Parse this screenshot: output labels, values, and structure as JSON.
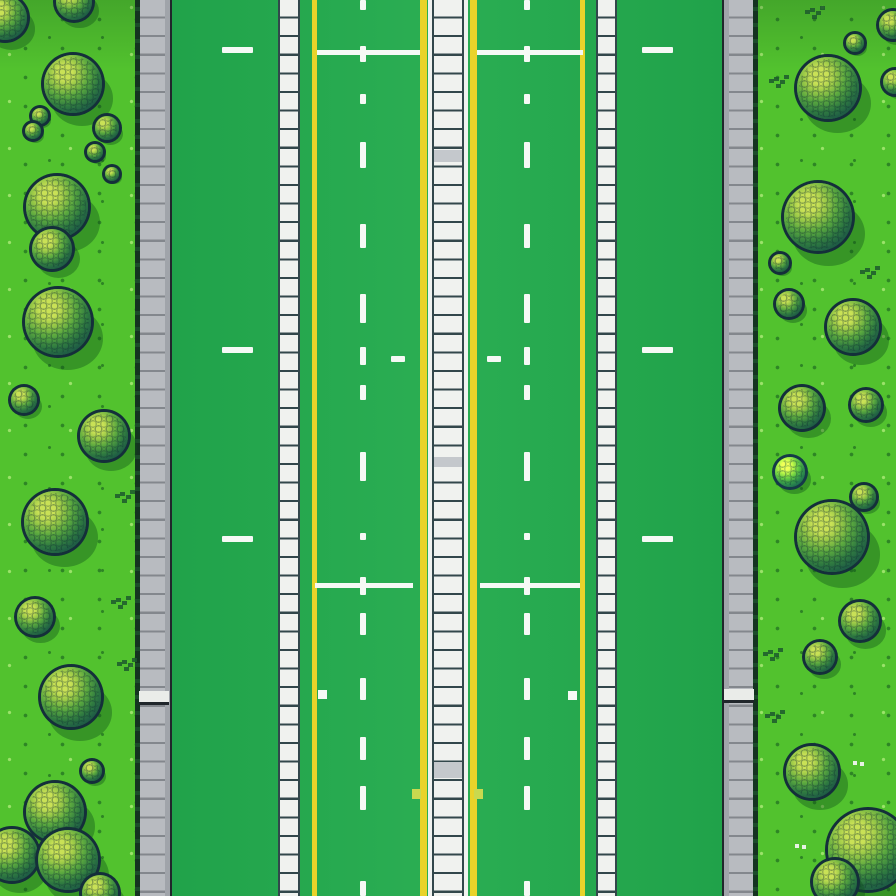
{
  "scene": {
    "description": "Top-down pixel-art game map: a green multi-lane road with yellow lines, white dashed lane markings, striped white median and sidewalk strips, gray curbs, and grass shoulders dotted with round scaly bushes",
    "width": 896,
    "height": 896,
    "colors": {
      "grass": "#52c22e",
      "grass_speck_dark": "#2e8525",
      "grass_speck_light": "#9be26a",
      "grass_top_shade": "rgba(18,70,30,0.22)",
      "road": "#1fa149",
      "road_light": "#2bae53",
      "curb": "#b8bbc0",
      "curb_shade": "#a0a4aa",
      "curb_line": "#83878d",
      "curb_border": "#20262b",
      "curb_edge_a": "#143320",
      "curb_edge_b": "#1c4b2a",
      "ladder_fill": "#f0f2ef",
      "ladder_line": "#32474b",
      "ladder_gray": "#c4c8cc",
      "yellow": "#e9d32a",
      "marking": "#f5f9f5",
      "square_yellow": "#c9d94f",
      "ramp_white": "#eaece9",
      "tree_outline": "#142f3a",
      "tree_hi": "#c9e156",
      "tree_mid2": "#9ecb48",
      "tree_mid": "#5aa83f",
      "tree_dark2": "#2f7a40",
      "tree_dark": "#1d5a45",
      "tree_deep": "#113046",
      "tree_shadow": "rgba(14,77,26,0.38)",
      "speck": "#1d5a2d",
      "white_speck": "#e8f2e4"
    },
    "grass_strips": [
      {
        "x": 0,
        "w": 140,
        "side": "left"
      },
      {
        "x": 752,
        "w": 144,
        "side": "right"
      }
    ],
    "road_rect": {
      "x": 140,
      "w": 614
    },
    "curbs": [
      {
        "x": 135,
        "w": 37,
        "side": "left"
      },
      {
        "x": 722,
        "w": 36,
        "side": "right"
      }
    ],
    "sidewalk_strips": [
      {
        "x": 278,
        "w": 22
      },
      {
        "x": 596,
        "w": 21
      }
    ],
    "yellow_lines": [
      {
        "x": 312,
        "w": 5
      },
      {
        "x": 580,
        "w": 5
      }
    ],
    "median": {
      "x": 420,
      "parts": [
        [
          "yellow",
          7
        ],
        [
          "road",
          1
        ],
        [
          "edge",
          4
        ],
        [
          "line",
          2
        ],
        [
          "fill",
          28
        ],
        [
          "line",
          2
        ],
        [
          "edge",
          4
        ],
        [
          "road",
          2
        ],
        [
          "yellow",
          7
        ]
      ],
      "gray_rungs": [
        [
          150,
          12
        ],
        [
          457,
          10
        ],
        [
          762,
          16
        ]
      ]
    },
    "rung_pitch": 18.6,
    "markings": {
      "dash_columns_x": [
        360,
        524
      ],
      "dash_w": 6,
      "v_dashes": [
        [
          0,
          10
        ],
        [
          46,
          16
        ],
        [
          94,
          10
        ],
        [
          142,
          26
        ],
        [
          224,
          24
        ],
        [
          294,
          29
        ],
        [
          347,
          18
        ],
        [
          385,
          15
        ],
        [
          452,
          29
        ],
        [
          533,
          7
        ],
        [
          577,
          18
        ],
        [
          613,
          22
        ],
        [
          678,
          22
        ],
        [
          737,
          23
        ],
        [
          786,
          24
        ],
        [
          881,
          15
        ]
      ],
      "h_dash_xs": [
        222,
        642
      ],
      "h_dash_ys": [
        47,
        347,
        536
      ],
      "h_dash_w": 31,
      "h_dash_h": 6,
      "mini_dashes": [
        [
          391,
          356
        ],
        [
          487,
          356
        ]
      ],
      "mini_w": 14,
      "mini_h": 6,
      "cross_lines": [
        {
          "y": 50,
          "h": 5,
          "spans": [
            [
              317,
              420
            ],
            [
              477,
              583
            ]
          ]
        },
        {
          "y": 583,
          "h": 5,
          "spans": [
            [
              315,
              413
            ],
            [
              480,
              580
            ]
          ]
        }
      ],
      "white_squares": [
        [
          318,
          690
        ],
        [
          568,
          691
        ]
      ],
      "square_size": 9,
      "yellow_squares": [
        [
          412,
          789
        ],
        [
          474,
          789
        ]
      ],
      "curb_ramps": [
        [
          139,
          691
        ],
        [
          724,
          689
        ]
      ],
      "ramp_w": 30,
      "ramp_h": 14
    },
    "trees": [
      {
        "cx": 5,
        "cy": 18,
        "r": 22
      },
      {
        "cx": 74,
        "cy": 2,
        "r": 18
      },
      {
        "cx": 73,
        "cy": 84,
        "r": 29
      },
      {
        "cx": 40,
        "cy": 116,
        "r": 8
      },
      {
        "cx": 107,
        "cy": 128,
        "r": 12
      },
      {
        "cx": 33,
        "cy": 131,
        "r": 8
      },
      {
        "cx": 95,
        "cy": 152,
        "r": 8
      },
      {
        "cx": 112,
        "cy": 174,
        "r": 7
      },
      {
        "cx": 57,
        "cy": 207,
        "r": 31
      },
      {
        "cx": 52,
        "cy": 249,
        "r": 20
      },
      {
        "cx": 58,
        "cy": 322,
        "r": 33
      },
      {
        "cx": 24,
        "cy": 400,
        "r": 13
      },
      {
        "cx": 104,
        "cy": 436,
        "r": 24
      },
      {
        "cx": 55,
        "cy": 522,
        "r": 31
      },
      {
        "cx": 35,
        "cy": 617,
        "r": 18
      },
      {
        "cx": 71,
        "cy": 697,
        "r": 30
      },
      {
        "cx": 92,
        "cy": 771,
        "r": 10
      },
      {
        "cx": 55,
        "cy": 812,
        "r": 29
      },
      {
        "cx": 12,
        "cy": 855,
        "r": 26
      },
      {
        "cx": 68,
        "cy": 860,
        "r": 30
      },
      {
        "cx": 100,
        "cy": 893,
        "r": 18
      },
      {
        "cx": 893,
        "cy": 25,
        "r": 14
      },
      {
        "cx": 855,
        "cy": 43,
        "r": 9
      },
      {
        "cx": 828,
        "cy": 88,
        "r": 31
      },
      {
        "cx": 895,
        "cy": 82,
        "r": 12
      },
      {
        "cx": 818,
        "cy": 217,
        "r": 34
      },
      {
        "cx": 780,
        "cy": 263,
        "r": 9
      },
      {
        "cx": 789,
        "cy": 304,
        "r": 13
      },
      {
        "cx": 853,
        "cy": 327,
        "r": 26
      },
      {
        "cx": 866,
        "cy": 405,
        "r": 15
      },
      {
        "cx": 802,
        "cy": 408,
        "r": 21
      },
      {
        "cx": 790,
        "cy": 472,
        "r": 15,
        "variant": "light"
      },
      {
        "cx": 864,
        "cy": 497,
        "r": 12
      },
      {
        "cx": 832,
        "cy": 537,
        "r": 35
      },
      {
        "cx": 860,
        "cy": 621,
        "r": 19
      },
      {
        "cx": 820,
        "cy": 657,
        "r": 15
      },
      {
        "cx": 812,
        "cy": 772,
        "r": 26
      },
      {
        "cx": 868,
        "cy": 850,
        "r": 40
      },
      {
        "cx": 835,
        "cy": 882,
        "r": 22
      }
    ],
    "grass_specks": [
      [
        120,
        492
      ],
      [
        116,
        598
      ],
      [
        122,
        660
      ],
      [
        774,
        77
      ],
      [
        810,
        8
      ],
      [
        865,
        268
      ],
      [
        768,
        650
      ],
      [
        770,
        712
      ]
    ],
    "white_specks": [
      [
        853,
        761
      ],
      [
        795,
        844
      ]
    ]
  }
}
